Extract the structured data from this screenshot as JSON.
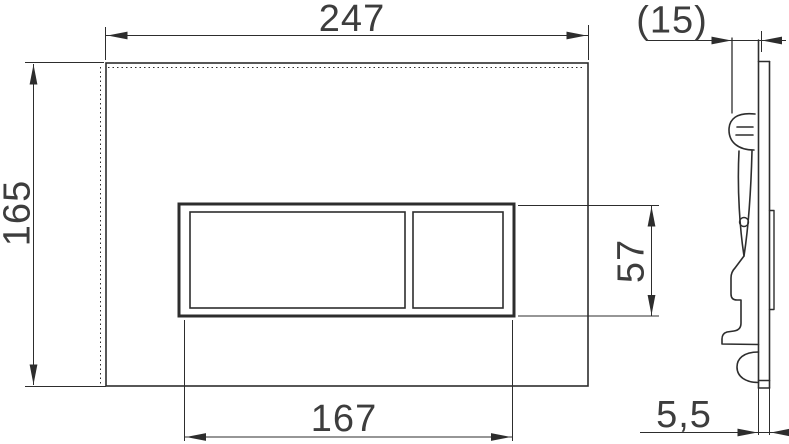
{
  "drawing": {
    "type": "technical-dimension-drawing",
    "subject": "wall flush plate with dual buttons, front view and side profile view",
    "views": [
      "front",
      "side"
    ],
    "colors": {
      "background": "#ffffff",
      "line": "#2d2d2d",
      "text": "#3d3d3d"
    },
    "dims": {
      "outer_width": "247",
      "outer_height": "165",
      "opening_width": "167",
      "opening_height": "57",
      "install_depth": "(15)",
      "plate_thickness": "5,5"
    }
  }
}
